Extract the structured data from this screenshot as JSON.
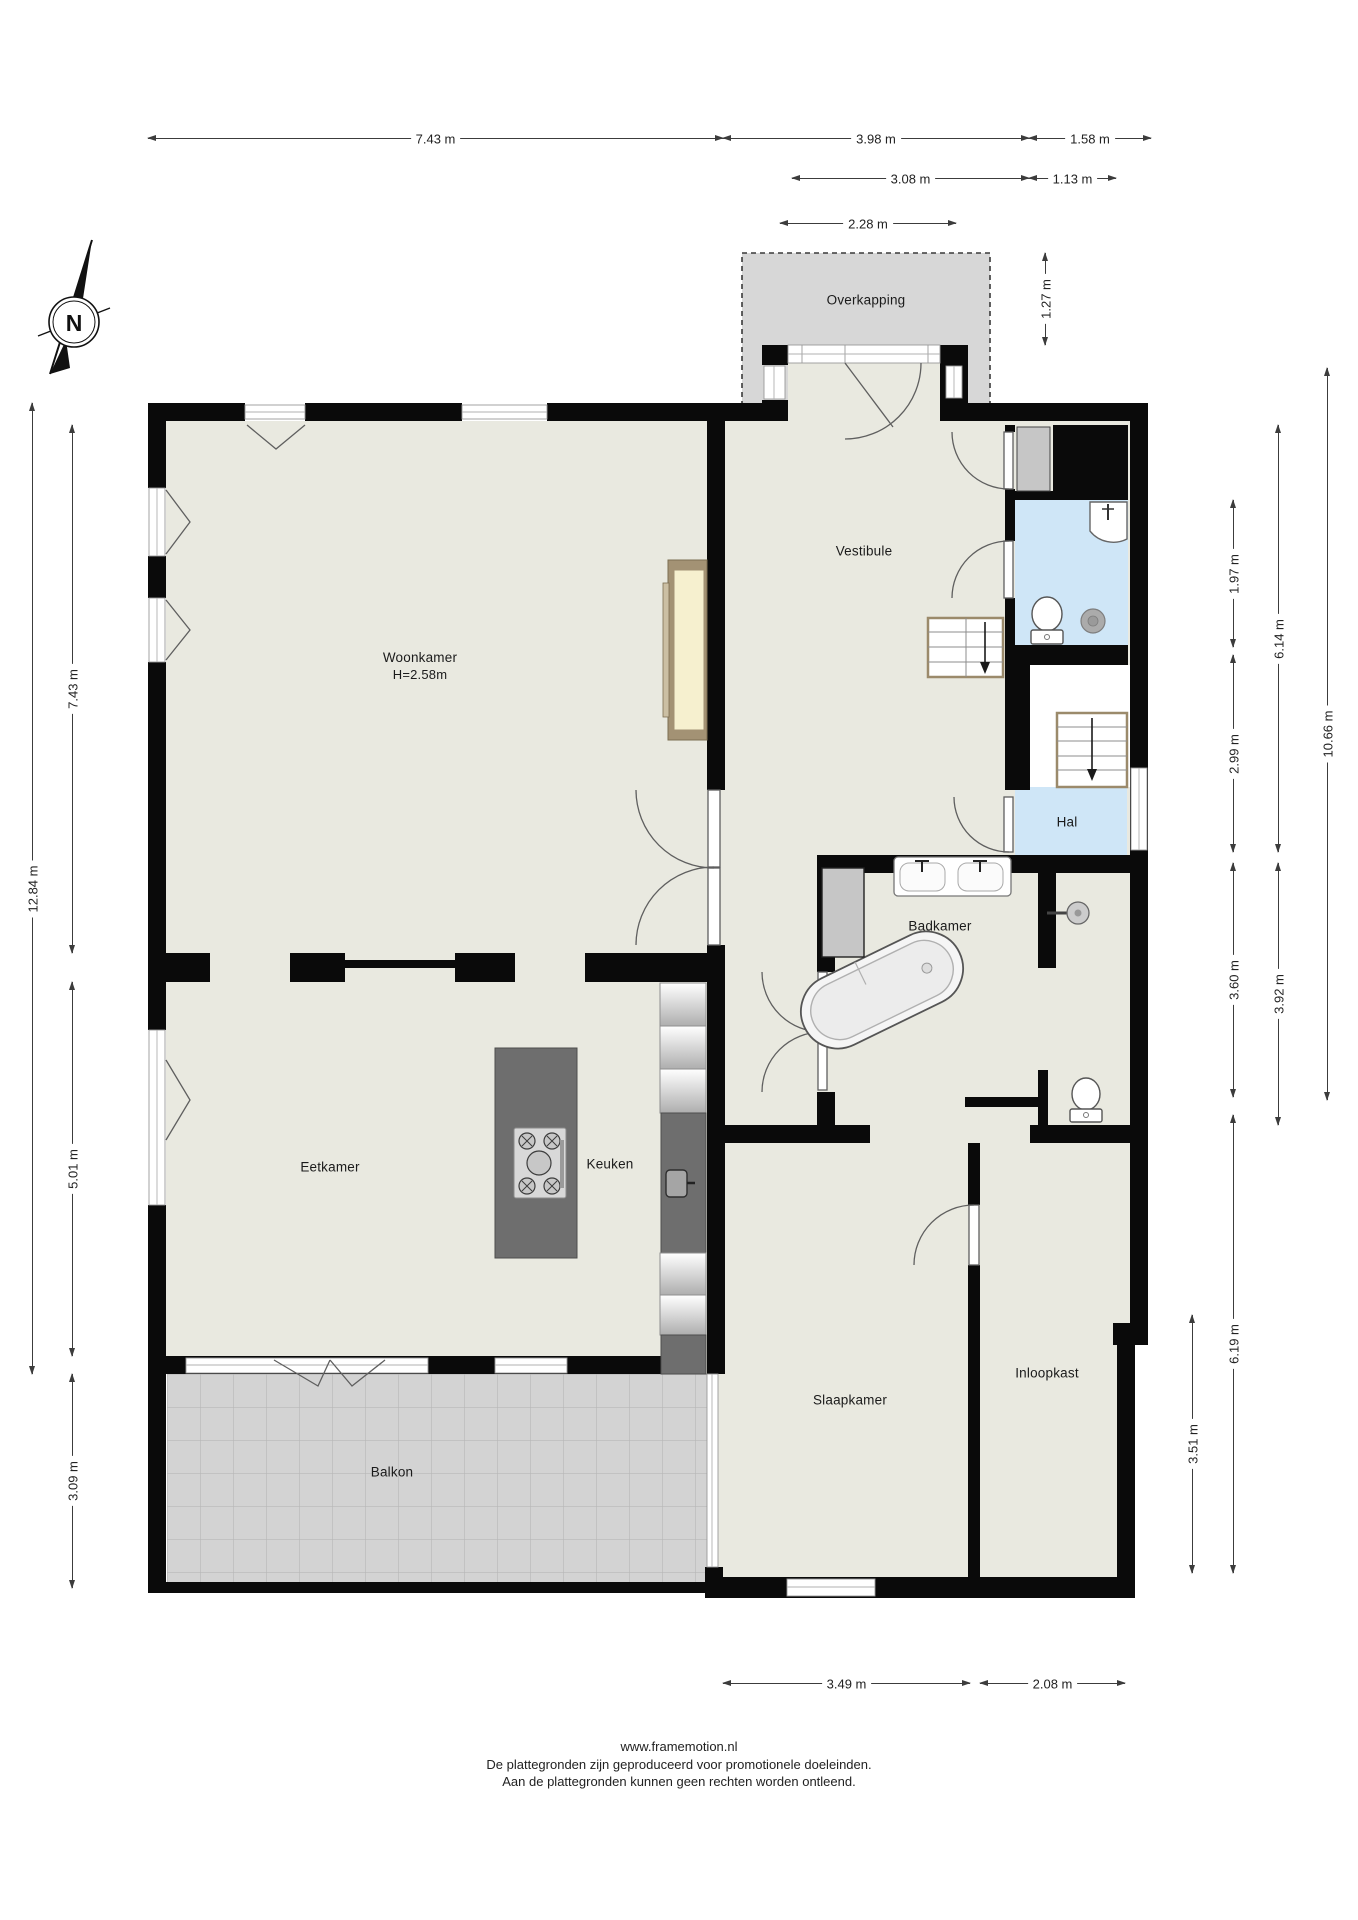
{
  "compass": {
    "label": "N"
  },
  "rooms": [
    {
      "id": "overkapping",
      "label": "Overkapping",
      "x": 866,
      "y": 300
    },
    {
      "id": "vestibule",
      "label": "Vestibule",
      "x": 864,
      "y": 551
    },
    {
      "id": "woonkamer",
      "label": "Woonkamer",
      "sub": "H=2.58m",
      "x": 420,
      "y": 666
    },
    {
      "id": "hal",
      "label": "Hal",
      "x": 1067,
      "y": 822
    },
    {
      "id": "badkamer",
      "label": "Badkamer",
      "x": 940,
      "y": 926
    },
    {
      "id": "eetkamer",
      "label": "Eetkamer",
      "x": 330,
      "y": 1167
    },
    {
      "id": "keuken",
      "label": "Keuken",
      "x": 610,
      "y": 1164
    },
    {
      "id": "slaapkamer",
      "label": "Slaapkamer",
      "x": 850,
      "y": 1400
    },
    {
      "id": "inloopkast",
      "label": "Inloopkast",
      "x": 1047,
      "y": 1373
    },
    {
      "id": "balkon",
      "label": "Balkon",
      "x": 392,
      "y": 1472
    }
  ],
  "dimensions": {
    "horizontal": [
      {
        "label": "7.43 m",
        "x1": 148,
        "x2": 723,
        "y": 138
      },
      {
        "label": "3.98 m",
        "x1": 723,
        "x2": 1029,
        "y": 138
      },
      {
        "label": "1.58 m",
        "x1": 1029,
        "x2": 1151,
        "y": 138
      },
      {
        "label": "3.08 m",
        "x1": 792,
        "x2": 1029,
        "y": 178
      },
      {
        "label": "1.13 m",
        "x1": 1029,
        "x2": 1116,
        "y": 178
      },
      {
        "label": "2.28 m",
        "x1": 780,
        "x2": 956,
        "y": 223
      },
      {
        "label": "3.49 m",
        "x1": 723,
        "x2": 970,
        "y": 1683
      },
      {
        "label": "2.08 m",
        "x1": 980,
        "x2": 1125,
        "y": 1683
      }
    ],
    "vertical": [
      {
        "label": "1.27 m",
        "x": 1045,
        "y1": 253,
        "y2": 345
      },
      {
        "label": "12.84 m",
        "x": 32,
        "y1": 403,
        "y2": 1374
      },
      {
        "label": "7.43 m",
        "x": 72,
        "y1": 425,
        "y2": 953
      },
      {
        "label": "5.01 m",
        "x": 72,
        "y1": 982,
        "y2": 1356
      },
      {
        "label": "3.09 m",
        "x": 72,
        "y1": 1374,
        "y2": 1588
      },
      {
        "label": "1.97 m",
        "x": 1233,
        "y1": 500,
        "y2": 647
      },
      {
        "label": "2.99 m",
        "x": 1233,
        "y1": 655,
        "y2": 852
      },
      {
        "label": "3.60 m",
        "x": 1233,
        "y1": 863,
        "y2": 1097
      },
      {
        "label": "6.19 m",
        "x": 1233,
        "y1": 1115,
        "y2": 1573
      },
      {
        "label": "6.14 m",
        "x": 1278,
        "y1": 425,
        "y2": 852
      },
      {
        "label": "3.92 m",
        "x": 1278,
        "y1": 863,
        "y2": 1125
      },
      {
        "label": "10.66 m",
        "x": 1327,
        "y1": 368,
        "y2": 1100
      },
      {
        "label": "3.51 m",
        "x": 1192,
        "y1": 1315,
        "y2": 1573
      }
    ]
  },
  "footer": {
    "lines": [
      "www.framemotion.nl",
      "De plattegronden zijn geproduceerd voor promotionele doeleinden.",
      "Aan de plattegronden kunnen geen rechten worden ontleend."
    ]
  },
  "colors": {
    "wall": "#0a0a0a",
    "floor": "#e9e9e0",
    "wet_room": "#cfe6f7",
    "overkapping": "#d7d7d7",
    "balcony_tile": "#d3d3d3",
    "counter": "#6e6e6e"
  }
}
